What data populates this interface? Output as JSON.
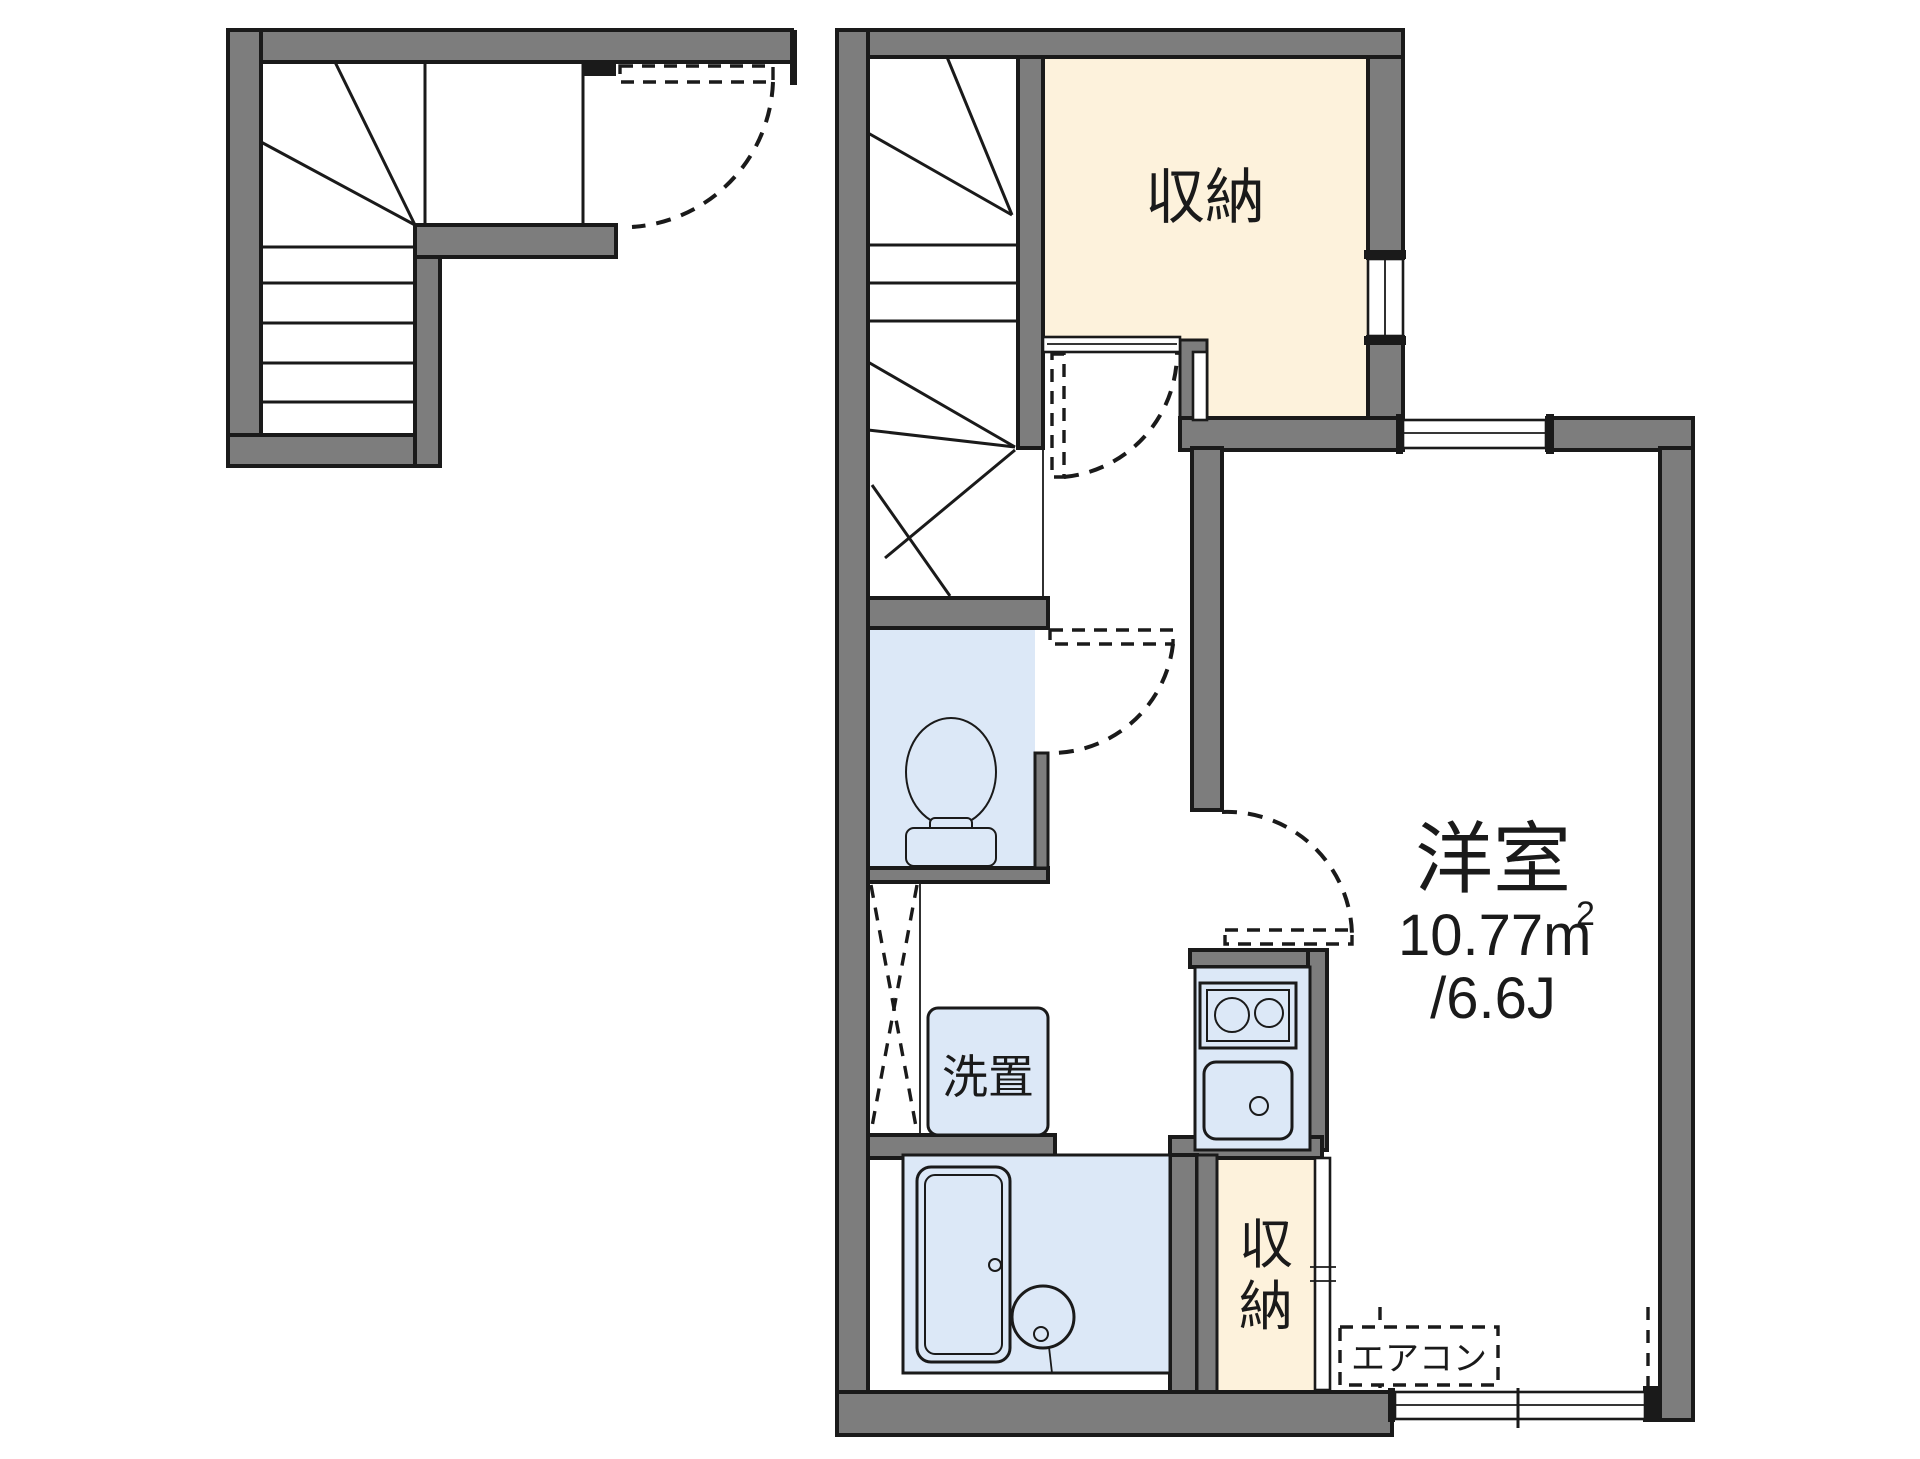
{
  "plan": {
    "colors": {
      "wall_gray": "#7d7d7d",
      "storage_cream": "#fdf2dc",
      "fixture_blue": "#dce8f7",
      "line_black": "#1a1a1a"
    },
    "rooms": {
      "storage_top": {
        "label": "収納"
      },
      "storage_bottom": {
        "char1": "収",
        "char2": "納"
      },
      "western": {
        "label": "洋室",
        "area": "10.77m",
        "area_sup": "2",
        "tatami": "/6.6J"
      }
    },
    "fixtures": {
      "washer": {
        "label": "洗置"
      },
      "aircon": {
        "label": "エアコン"
      }
    }
  }
}
